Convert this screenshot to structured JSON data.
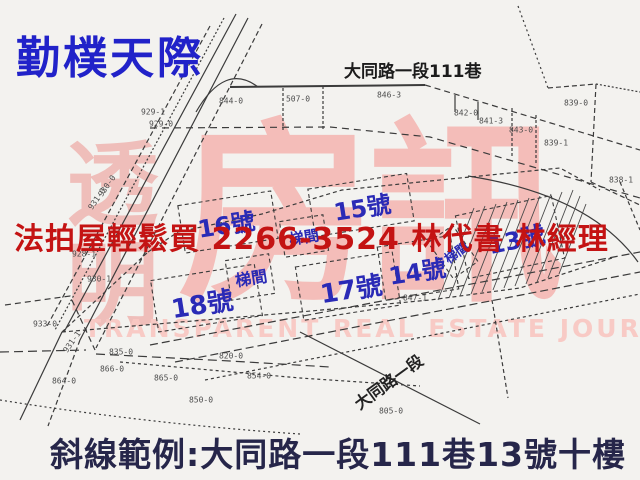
{
  "title": "勤樸天際",
  "streets": {
    "top": "大同路一段111巷",
    "bottom_diagonal": "大同路一段"
  },
  "overlay_ad": "法拍屋輕鬆買 2266-3524 林代書 林經理",
  "caption": "斜線範例:大同路一段111巷13號十樓",
  "watermark": {
    "vertical": "透明",
    "main": "房訊",
    "subtitle": "TRANSPARENT REAL ESTATE JOURNAL"
  },
  "units": [
    {
      "label": "16號",
      "x": 226,
      "y": 223,
      "size": 24,
      "rot": -9
    },
    {
      "label": "15號",
      "x": 362,
      "y": 206,
      "size": 24,
      "rot": -9
    },
    {
      "label": "梯間",
      "x": 304,
      "y": 237,
      "size": 15,
      "rot": -9
    },
    {
      "label": "18號",
      "x": 202,
      "y": 303,
      "size": 26,
      "rot": -9
    },
    {
      "label": "梯間",
      "x": 251,
      "y": 277,
      "size": 16,
      "rot": -9
    },
    {
      "label": "17號",
      "x": 351,
      "y": 288,
      "size": 26,
      "rot": -9
    },
    {
      "label": "14號",
      "x": 417,
      "y": 270,
      "size": 24,
      "rot": -9
    },
    {
      "label": "13號",
      "x": 516,
      "y": 238,
      "size": 24,
      "rot": -12
    },
    {
      "label": "梯間",
      "x": 456,
      "y": 252,
      "size": 13,
      "rot": -35
    }
  ],
  "parcels": [
    {
      "id": "844-0",
      "x": 231,
      "y": 101,
      "rot": 0
    },
    {
      "id": "507-0",
      "x": 298,
      "y": 99,
      "rot": 0
    },
    {
      "id": "846-3",
      "x": 389,
      "y": 95,
      "rot": 0
    },
    {
      "id": "842-0",
      "x": 466,
      "y": 113,
      "rot": 0
    },
    {
      "id": "841-3",
      "x": 491,
      "y": 121,
      "rot": 0
    },
    {
      "id": "843-0",
      "x": 521,
      "y": 130,
      "rot": 0
    },
    {
      "id": "839-0",
      "x": 576,
      "y": 103,
      "rot": 0
    },
    {
      "id": "839-1",
      "x": 556,
      "y": 143,
      "rot": 0
    },
    {
      "id": "838-1",
      "x": 621,
      "y": 180,
      "rot": 0
    },
    {
      "id": "929-1",
      "x": 153,
      "y": 112,
      "rot": 0
    },
    {
      "id": "929-0",
      "x": 161,
      "y": 124,
      "rot": 0
    },
    {
      "id": "930-0",
      "x": 107,
      "y": 186,
      "rot": -55
    },
    {
      "id": "931-0",
      "x": 97,
      "y": 199,
      "rot": -55
    },
    {
      "id": "928-1",
      "x": 84,
      "y": 254,
      "rot": 0
    },
    {
      "id": "930-1",
      "x": 99,
      "y": 279,
      "rot": 0
    },
    {
      "id": "933-0",
      "x": 45,
      "y": 324,
      "rot": 0
    },
    {
      "id": "931-1",
      "x": 72,
      "y": 342,
      "rot": -55
    },
    {
      "id": "835-0",
      "x": 121,
      "y": 352,
      "rot": 0
    },
    {
      "id": "820-0",
      "x": 231,
      "y": 356,
      "rot": 0
    },
    {
      "id": "866-0",
      "x": 112,
      "y": 369,
      "rot": 0
    },
    {
      "id": "864-0",
      "x": 64,
      "y": 381,
      "rot": 0
    },
    {
      "id": "865-0",
      "x": 166,
      "y": 378,
      "rot": 0
    },
    {
      "id": "854-0",
      "x": 259,
      "y": 376,
      "rot": 0
    },
    {
      "id": "850-0",
      "x": 201,
      "y": 400,
      "rot": 0
    },
    {
      "id": "847-1",
      "x": 415,
      "y": 298,
      "rot": 0
    },
    {
      "id": "805-0",
      "x": 391,
      "y": 411,
      "rot": 0
    }
  ],
  "colors": {
    "title_blue": "#2122c9",
    "unit_blue": "#2a2ab6",
    "ad_red": "#c41313",
    "caption_navy": "#26264a",
    "watermark_pink": "#f3b4af",
    "line_gray": "#3b3b3b",
    "background": "#f3f2ef"
  }
}
